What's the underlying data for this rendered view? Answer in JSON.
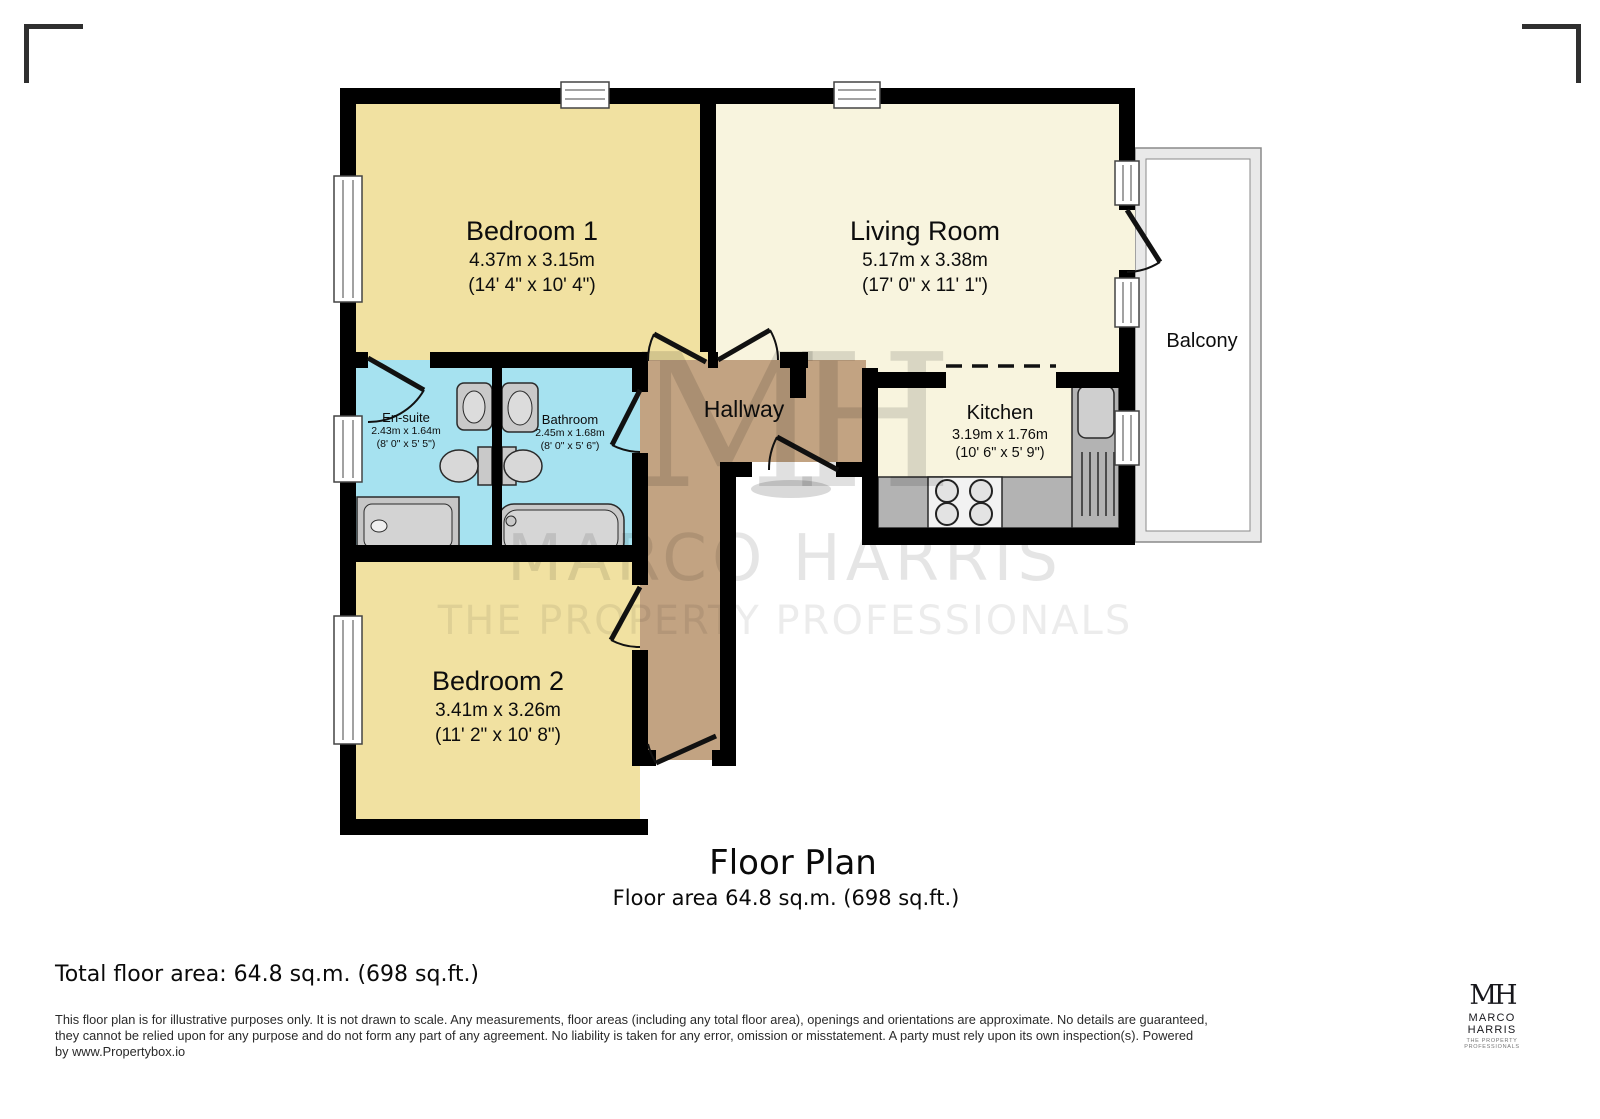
{
  "colors": {
    "wall": "#000000",
    "bedroom_floor": "#F1E1A1",
    "living_floor": "#F8F4DE",
    "bath_floor": "#A6E2F0",
    "hallway_floor": "#C2A382",
    "counter_gray": "#B3B3B3",
    "balcony_rail": "#E9E9E9",
    "watermark": "rgba(0,0,0,0.10)"
  },
  "rooms": {
    "bedroom1": {
      "name": "Bedroom 1",
      "dims_m": "4.37m x 3.15m",
      "dims_ft": "(14' 4\" x 10' 4\")"
    },
    "living_room": {
      "name": "Living Room",
      "dims_m": "5.17m x 3.38m",
      "dims_ft": "(17' 0\" x 11' 1\")"
    },
    "ensuite": {
      "name": "En-suite",
      "dims_m": "2.43m x 1.64m",
      "dims_ft": "(8' 0\" x 5' 5\")"
    },
    "bathroom": {
      "name": "Bathroom",
      "dims_m": "2.45m x 1.68m",
      "dims_ft": "(8' 0\" x 5' 6\")"
    },
    "hallway": {
      "name": "Hallway"
    },
    "kitchen": {
      "name": "Kitchen",
      "dims_m": "3.19m x 1.76m",
      "dims_ft": "(10' 6\" x 5' 9\")"
    },
    "bedroom2": {
      "name": "Bedroom 2",
      "dims_m": "3.41m x 3.26m",
      "dims_ft": "(11' 2\" x 10' 8\")"
    },
    "balcony": {
      "name": "Balcony"
    }
  },
  "watermark": {
    "monogram": "MH",
    "line1": "MARCO HARRIS",
    "line2": "THE PROPERTY PROFESSIONALS"
  },
  "title": {
    "heading": "Floor Plan",
    "subheading": "Floor area 64.8 sq.m. (698 sq.ft.)"
  },
  "footer": {
    "total_area": "Total floor area: 64.8 sq.m. (698 sq.ft.)",
    "disclaimer_lines": [
      "This floor plan is for illustrative purposes only. It is not drawn to scale. Any measurements, floor areas (including any total floor area), openings and orientations are approximate. No details are guaranteed,",
      "they cannot be relied upon for any purpose and do not form any part of any agreement. No liability is taken for any error, omission or misstatement. A party must rely upon its own inspection(s). Powered",
      "by www.Propertybox.io"
    ],
    "logo": {
      "monogram": "MH",
      "name": "MARCO HARRIS",
      "tagline": "THE PROPERTY PROFESSIONALS"
    }
  }
}
